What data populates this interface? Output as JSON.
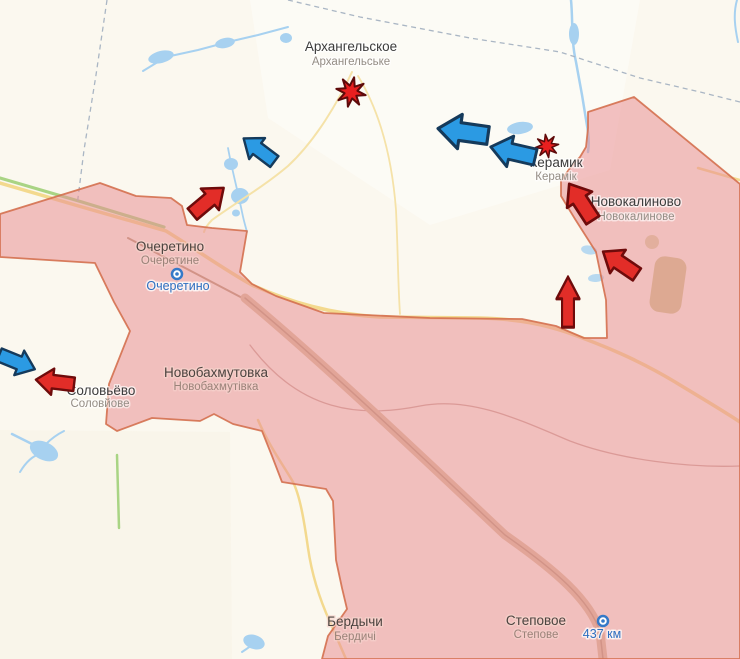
{
  "map": {
    "towns": [
      {
        "id": "arkhanhelske",
        "ru": "Архангельское",
        "uk": "Архангельське"
      },
      {
        "id": "keramik",
        "ru": "Керамик",
        "uk": "Керамік"
      },
      {
        "id": "novokalynove",
        "ru": "Новокалиново",
        "uk": "Новокалинове"
      },
      {
        "id": "ocheretyne",
        "ru": "Очеретино",
        "uk": "Очеретине"
      },
      {
        "id": "novobakhmutivka",
        "ru": "Новобахмутовка",
        "uk": "Новобахмутівка"
      },
      {
        "id": "soloviove",
        "ru": "Соловьёво",
        "uk": "Соловйове"
      },
      {
        "id": "berdychi",
        "ru": "Бердычи",
        "uk": "Бердичі"
      },
      {
        "id": "stepove",
        "ru": "Степовое",
        "uk": "Степове"
      }
    ],
    "stations": [
      {
        "id": "ocheretyne-station",
        "name": "Очеретино"
      },
      {
        "id": "437km-station",
        "name": "437 км"
      }
    ],
    "markers": {
      "explosions": [
        {
          "near": "Архангельское"
        },
        {
          "near": "Керамик"
        }
      ],
      "arrows": [
        {
          "color": "blue",
          "heading": "west",
          "near": "Архангельское"
        },
        {
          "color": "blue",
          "heading": "west",
          "near": "Керамик"
        },
        {
          "color": "blue",
          "heading": "southwest",
          "near": "Очеретино"
        },
        {
          "color": "blue",
          "heading": "southeast",
          "near": "Соловьёво"
        },
        {
          "color": "red",
          "heading": "northeast",
          "near": "Очеретино"
        },
        {
          "color": "red",
          "heading": "west",
          "near": "Соловьёво"
        },
        {
          "color": "red",
          "heading": "northwest",
          "near": "Керамик"
        },
        {
          "color": "red",
          "heading": "northwest",
          "near": "Новокалиново"
        },
        {
          "color": "red",
          "heading": "north",
          "near": "Новокалиново"
        }
      ]
    },
    "colors": {
      "occupied_fill": "#f3c1c4",
      "occupied_border": "#d4704f",
      "arrow_blue": "#2b9ae3",
      "arrow_red": "#e22d28",
      "water": "#a7d1f0",
      "road": "#f3d98e",
      "railway": "#d9bf9e",
      "background": "#fbf8ef",
      "station_blue": "#2e6fc0"
    }
  }
}
